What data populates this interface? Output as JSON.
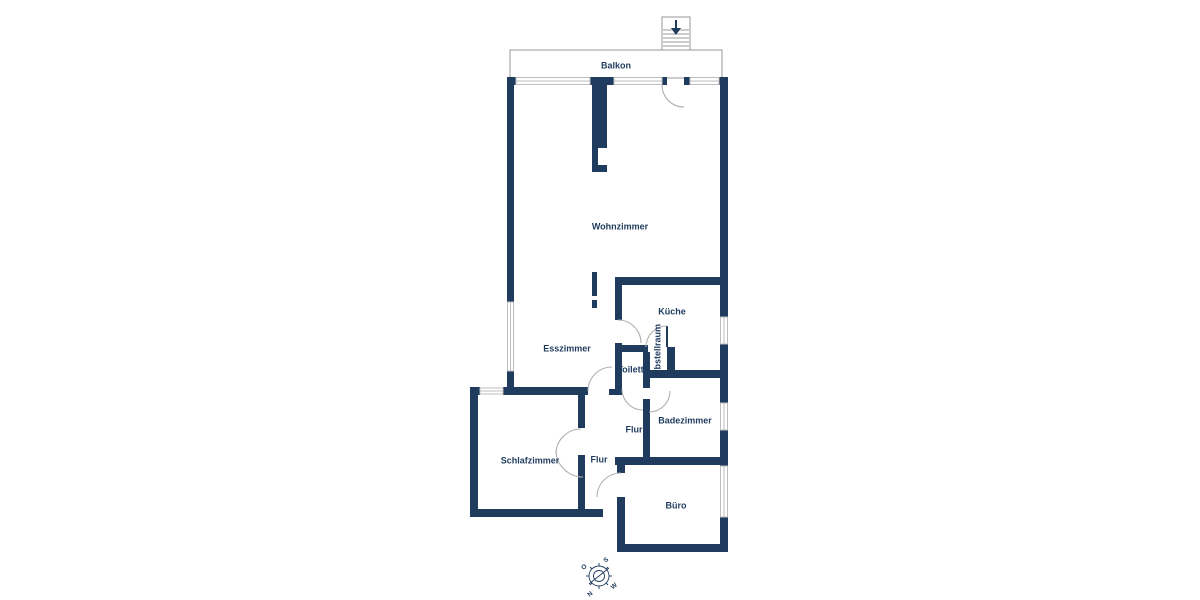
{
  "floor_plan": {
    "rooms": {
      "balkon": "Balkon",
      "wohnzimmer": "Wohnzimmer",
      "esszimmer": "Esszimmer",
      "kueche": "Küche",
      "abstellraum": "Abstellraum",
      "toilette": "Toilette",
      "flur_upper": "Flur",
      "badezimmer": "Badezimmer",
      "schlafzimmer": "Schlafzimmer",
      "flur_lower": "Flur",
      "buero": "Büro"
    },
    "compass": {
      "north": "N",
      "east": "O",
      "south": "S",
      "west": "W"
    },
    "colors": {
      "wall": "#1f3b5e",
      "door_arc": "#b0b0b0",
      "window_line": "#bdbdbd",
      "outline": "#999999"
    }
  }
}
